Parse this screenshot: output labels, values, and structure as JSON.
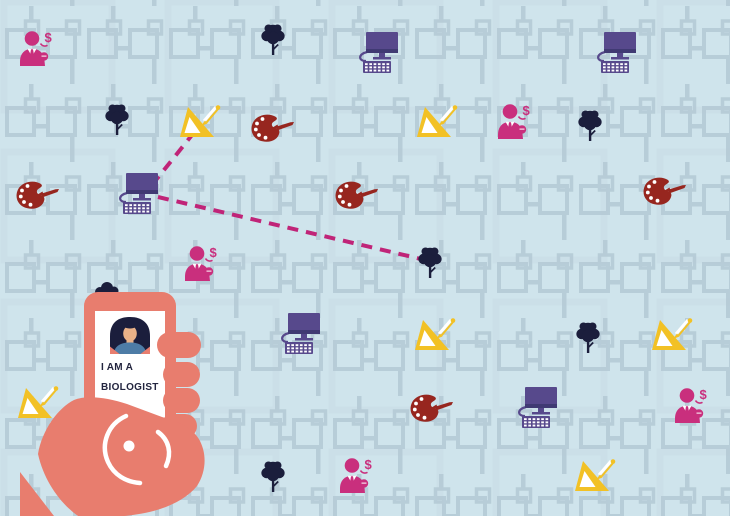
{
  "phone_card": {
    "line1": "I AM A",
    "line2": "BIOLOGIST",
    "avatar": "woman-avatar"
  },
  "colors": {
    "background": "#cfe4ec",
    "pattern_line": "#b3c9d4",
    "pattern_line_light": "#c6dbe3",
    "magenta": "#c92f7d",
    "navy": "#1b1e3c",
    "purple": "#57498c",
    "purple_dark": "#403a73",
    "dark_red": "#97261f",
    "gold": "#f2c125",
    "coral": "#e87d6e",
    "dash_line": "#c02478",
    "skin": "#eab288",
    "shirt_blue": "#4d7ca6",
    "text_navy": "#23253f"
  },
  "icons": [
    {
      "type": "person-dollar",
      "x": 38,
      "y": 48
    },
    {
      "type": "tree",
      "x": 273,
      "y": 40
    },
    {
      "type": "computer",
      "x": 378,
      "y": 52
    },
    {
      "type": "computer",
      "x": 616,
      "y": 52
    },
    {
      "type": "tree",
      "x": 117,
      "y": 120
    },
    {
      "type": "set-square",
      "x": 200,
      "y": 124
    },
    {
      "type": "palette",
      "x": 273,
      "y": 128
    },
    {
      "type": "set-square",
      "x": 437,
      "y": 124
    },
    {
      "type": "person-dollar",
      "x": 516,
      "y": 121
    },
    {
      "type": "tree",
      "x": 590,
      "y": 126
    },
    {
      "type": "palette",
      "x": 38,
      "y": 195
    },
    {
      "type": "computer",
      "x": 138,
      "y": 193
    },
    {
      "type": "palette",
      "x": 357,
      "y": 195
    },
    {
      "type": "palette",
      "x": 665,
      "y": 191
    },
    {
      "type": "person-dollar",
      "x": 203,
      "y": 263
    },
    {
      "type": "tree",
      "x": 430,
      "y": 263
    },
    {
      "type": "computer",
      "x": 300,
      "y": 333
    },
    {
      "type": "set-square",
      "x": 435,
      "y": 337
    },
    {
      "type": "tree",
      "x": 588,
      "y": 338
    },
    {
      "type": "set-square",
      "x": 672,
      "y": 337
    },
    {
      "type": "set-square",
      "x": 38,
      "y": 405
    },
    {
      "type": "palette",
      "x": 432,
      "y": 408
    },
    {
      "type": "computer",
      "x": 537,
      "y": 407
    },
    {
      "type": "person-dollar",
      "x": 693,
      "y": 405
    },
    {
      "type": "tree",
      "x": 273,
      "y": 477
    },
    {
      "type": "person-dollar",
      "x": 358,
      "y": 475
    },
    {
      "type": "set-square",
      "x": 595,
      "y": 478
    }
  ],
  "connections": [
    {
      "x1": 152,
      "y1": 185,
      "x2": 196,
      "y2": 130
    },
    {
      "x1": 158,
      "y1": 197,
      "x2": 421,
      "y2": 259
    }
  ]
}
